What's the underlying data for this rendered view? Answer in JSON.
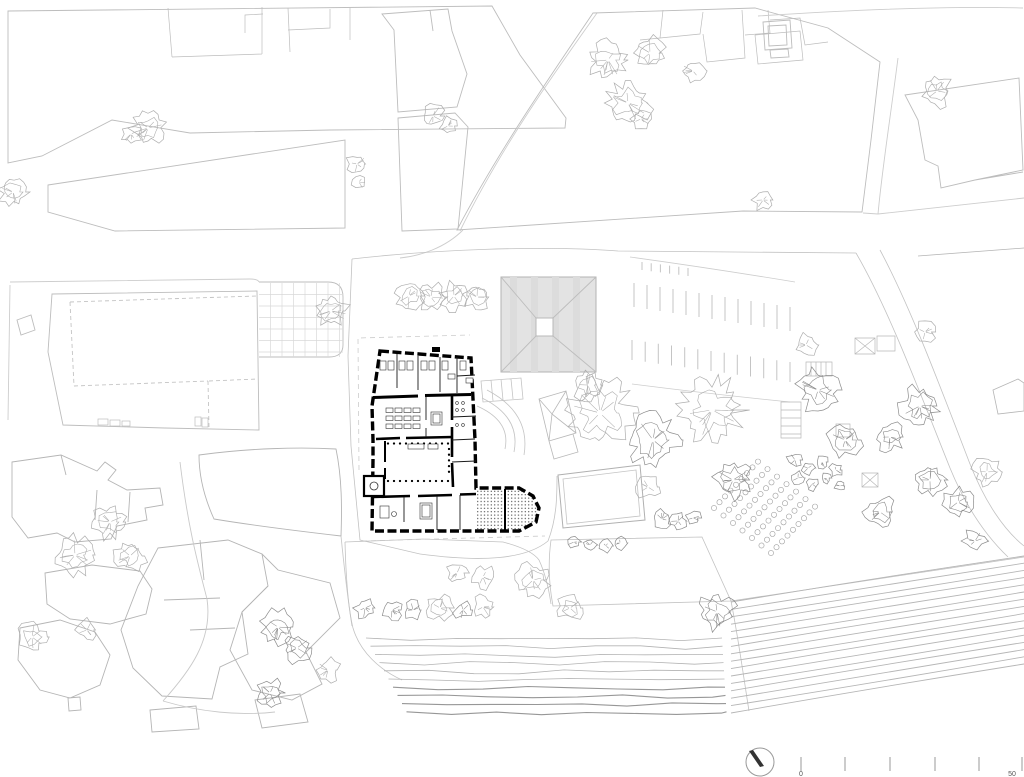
{
  "drawing": {
    "kind": "architectural-site-plan",
    "scale_bar": {
      "label_start": "0",
      "label_end": "50",
      "ticks_x": [
        801,
        845,
        890,
        935,
        979,
        1022
      ],
      "tick_top": 757,
      "tick_bottom": 771,
      "label_y": 776,
      "label_start_x": 801,
      "label_end_x": 1012
    },
    "north_arrow": {
      "cx": 760,
      "cy": 762,
      "r": 14
    }
  },
  "colors": {
    "context": "#bdbdbd",
    "context_light": "#cdcdcd",
    "grid": "#d9d9d9",
    "tree": "#adadad",
    "tree_dark": "#8c8c8c",
    "plan_black": "#000000",
    "roof_fill": "#e3e3e3",
    "roof_line": "#b3b3b3",
    "vine": "#b3b3b3",
    "vine_dark": "#979797",
    "tick": "#999999",
    "label": "#555555"
  },
  "grid_court": {
    "x": 259,
    "y": 283,
    "w": 84,
    "h": 74,
    "step": 11.5
  },
  "parking_bands": [
    {
      "x1": 634,
      "y1": 307,
      "x2": 790,
      "y2": 331,
      "n": 13,
      "len": 24
    },
    {
      "x1": 632,
      "y1": 360,
      "x2": 790,
      "y2": 382,
      "n": 13,
      "len": 20
    },
    {
      "x1": 642,
      "y1": 270,
      "x2": 688,
      "y2": 276,
      "n": 6,
      "len": 8
    }
  ],
  "orchard": {
    "x0": 714,
    "y0": 508,
    "rows": 7,
    "cols": 9,
    "di": [
      9.5,
      7.5
    ],
    "dj": [
      5.5,
      -5.8
    ],
    "r": 2.6
  },
  "vineyard_horizontal": {
    "x0": 366,
    "y0": 638,
    "rows": 10,
    "row_dy": 8.2,
    "x0_drift": 4.5,
    "x1": 722,
    "x1_drift": 0.5
  },
  "vineyard_diagonal": {
    "x1": 731,
    "y1_start": 602,
    "dy1": 7.4,
    "x2": 1024,
    "y2_start": 556,
    "dy2": 7.2,
    "count": 16
  },
  "trees": [
    [
      148,
      128,
      13,
      0
    ],
    [
      131,
      134,
      8,
      0
    ],
    [
      13,
      192,
      11,
      0
    ],
    [
      357,
      164,
      8,
      0
    ],
    [
      359,
      182,
      6,
      0
    ],
    [
      433,
      116,
      9,
      0
    ],
    [
      448,
      126,
      7,
      0
    ],
    [
      608,
      60,
      15,
      0
    ],
    [
      650,
      53,
      12,
      0
    ],
    [
      693,
      71,
      9,
      0
    ],
    [
      628,
      103,
      17,
      0
    ],
    [
      641,
      119,
      8,
      0
    ],
    [
      763,
      200,
      8,
      0
    ],
    [
      937,
      91,
      12,
      0
    ],
    [
      925,
      332,
      8,
      0
    ],
    [
      331,
      311,
      13,
      0
    ],
    [
      409,
      296,
      11,
      0
    ],
    [
      431,
      297,
      11,
      0
    ],
    [
      454,
      296,
      11,
      0
    ],
    [
      477,
      297,
      10,
      0
    ],
    [
      588,
      385,
      12,
      0
    ],
    [
      600,
      413,
      26,
      0
    ],
    [
      653,
      440,
      20,
      1
    ],
    [
      712,
      410,
      24,
      0
    ],
    [
      733,
      480,
      14,
      1
    ],
    [
      648,
      487,
      9,
      0
    ],
    [
      662,
      519,
      7,
      1
    ],
    [
      678,
      521,
      7,
      1
    ],
    [
      693,
      518,
      6,
      1
    ],
    [
      574,
      542,
      5,
      1
    ],
    [
      590,
      545,
      5,
      1
    ],
    [
      606,
      546,
      5,
      1
    ],
    [
      620,
      543,
      5,
      1
    ],
    [
      806,
      345,
      9,
      0
    ],
    [
      818,
      390,
      16,
      1
    ],
    [
      845,
      440,
      13,
      1
    ],
    [
      890,
      437,
      11,
      1
    ],
    [
      920,
      406,
      15,
      1
    ],
    [
      930,
      480,
      12,
      1
    ],
    [
      958,
      502,
      11,
      1
    ],
    [
      880,
      512,
      12,
      1
    ],
    [
      987,
      472,
      11,
      0
    ],
    [
      975,
      541,
      9,
      1
    ],
    [
      795,
      460,
      6,
      1
    ],
    [
      808,
      468,
      5,
      1
    ],
    [
      822,
      462,
      5,
      1
    ],
    [
      836,
      470,
      5,
      1
    ],
    [
      798,
      478,
      5,
      1
    ],
    [
      812,
      484,
      5,
      1
    ],
    [
      826,
      478,
      4,
      1
    ],
    [
      840,
      486,
      4,
      1
    ],
    [
      110,
      522,
      13,
      0
    ],
    [
      75,
      555,
      15,
      0
    ],
    [
      130,
      556,
      12,
      0
    ],
    [
      32,
      637,
      11,
      0
    ],
    [
      87,
      630,
      8,
      0
    ],
    [
      278,
      627,
      13,
      1
    ],
    [
      297,
      648,
      11,
      1
    ],
    [
      328,
      670,
      9,
      0
    ],
    [
      270,
      693,
      11,
      1
    ],
    [
      457,
      573,
      8,
      0
    ],
    [
      483,
      577,
      9,
      0
    ],
    [
      533,
      580,
      13,
      0
    ],
    [
      365,
      608,
      8,
      1
    ],
    [
      392,
      610,
      8,
      1
    ],
    [
      413,
      610,
      7,
      1
    ],
    [
      440,
      608,
      10,
      0
    ],
    [
      463,
      610,
      7,
      1
    ],
    [
      483,
      607,
      9,
      0
    ],
    [
      570,
      608,
      10,
      0
    ],
    [
      717,
      612,
      14,
      1
    ]
  ]
}
